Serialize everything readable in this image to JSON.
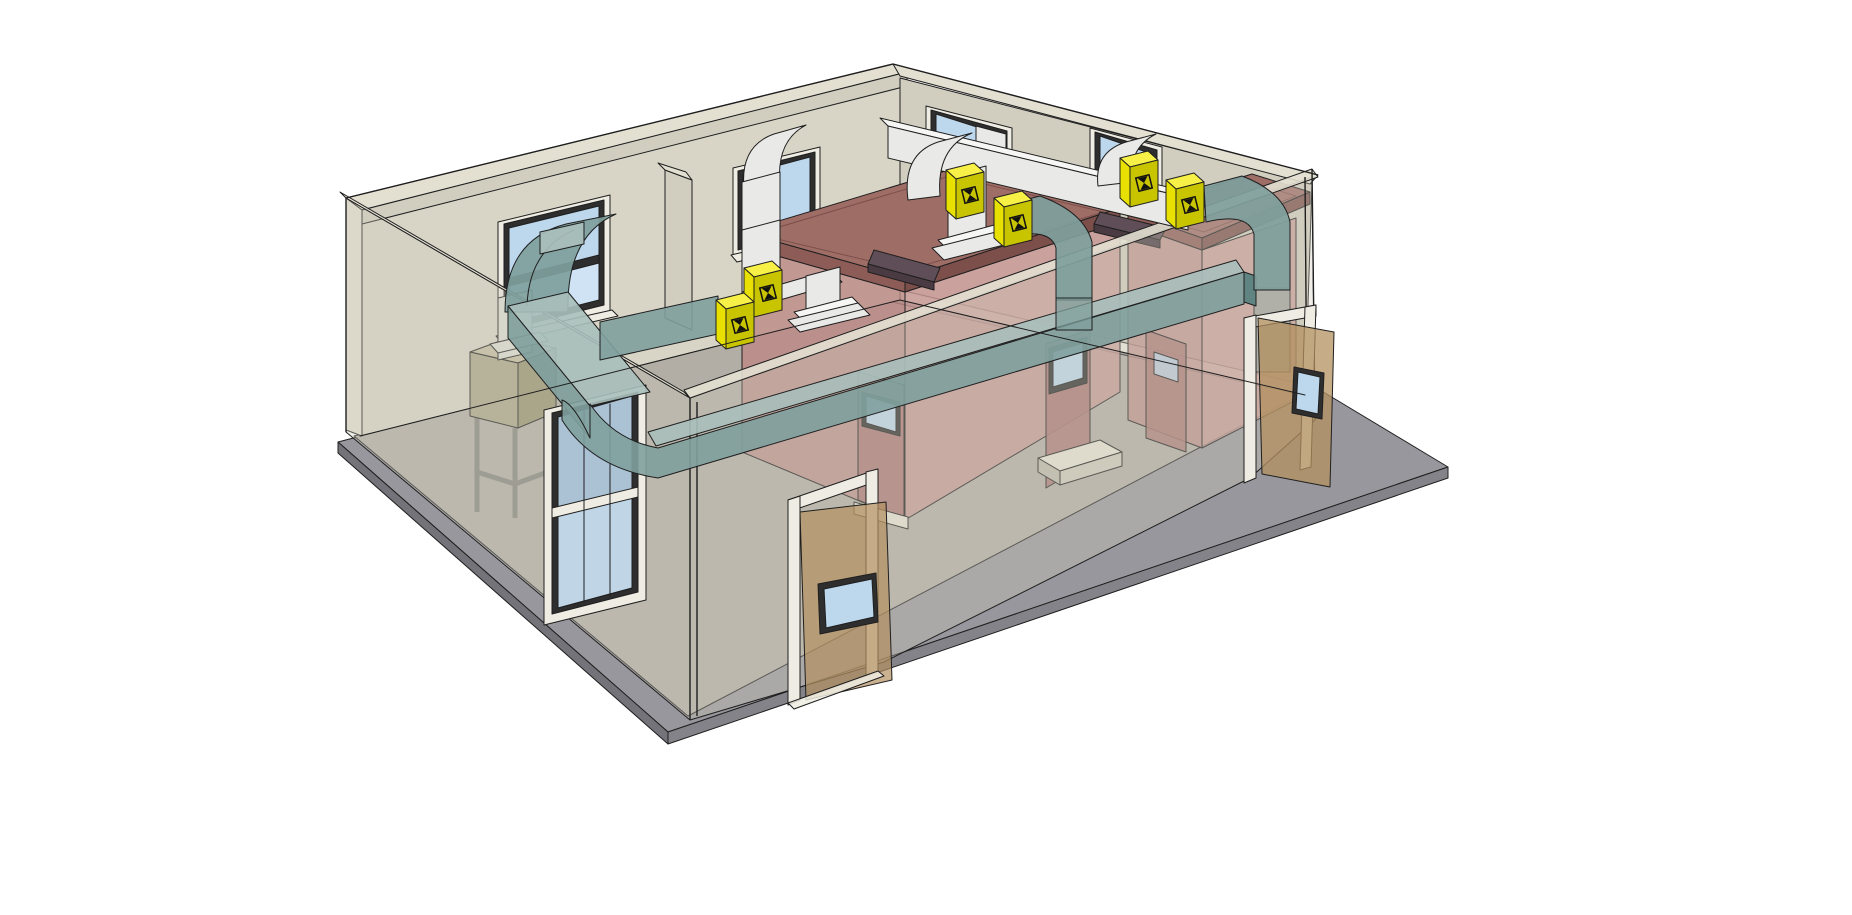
{
  "viewport": {
    "width": 1852,
    "height": 915,
    "background": "#ffffff",
    "description": "3D perspective model of a single-storey plant room: beige walls (front walls translucent), gray concrete slab apron, two red-brown test chambers with maroon roofs and vision-panel doors, white supply ductwork along the rear walls with drops and diffuser bases, teal extract ductwork looping around the room, yellow inline dampers, four rear windows, a glazed partition screen, a filter box on a stand, and two open timber doors"
  },
  "palette": {
    "line": "#1f1f1f",
    "wallA": "#d8d5c7",
    "wallB": "#d1cec0",
    "wallTop": "#e3e0d2",
    "ghost": "#cfccbe",
    "floorIn": "#b2aea5",
    "slab": "#98979d",
    "slabE": "#84838a",
    "slabE2": "#74737a",
    "glass": "#bdd7ec",
    "glass2": "#cfe3f4",
    "frameWhite": "#efede3",
    "frameDark": "#2e2e2e",
    "roof": "#9e6d66",
    "roofE": "#8d5c57",
    "roofE2": "#7d4f4b",
    "redWall": "#bd8a86",
    "redWall2": "#c89794",
    "redDoor": "#a87672",
    "slot": "#5f4e57",
    "slotS": "#4a3b43",
    "ductTop": "#f6f6f4",
    "ductFace": "#e9e9e7",
    "ductSide": "#d8d8d6",
    "teal": "#7fa09d",
    "tealTop": "#a9bfbb",
    "tealDark": "#5f8481",
    "ductLight": "#dcdcd4",
    "damperTop": "#f6f047",
    "damperFace": "#e8e000",
    "damperSide": "#c9c400",
    "glyph": "#111111",
    "doorWood": "#b3905f",
    "stepTop": "#e6e3d5",
    "stepFace": "#cdcabc",
    "stepSide": "#bdbaac",
    "boxTop": "#c2bc9e",
    "boxFace": "#aaa488",
    "boxS": "#97926f",
    "boxSide": "#97926f",
    "stand": "#85857f"
  },
  "scene": {
    "ground": {
      "slab": "concrete apron slab",
      "interior": "interior screed floor"
    },
    "building": {
      "walls": [
        "back-left wall",
        "back-right wall",
        "front-left wall (translucent)",
        "front-right wall (translucent)"
      ],
      "window_count": 4,
      "partition_stub": "interior partition stub wall",
      "glazed_screen": "full-height glazed partition screen"
    },
    "chambers": {
      "count": 2,
      "color": "red-brown",
      "chamber_a": {
        "doors": 2,
        "roof_slot_vents": 1,
        "step_blocks": 2
      },
      "chamber_b": {
        "doors": 1,
        "roof_slot_vents": 1
      }
    },
    "ductwork": {
      "supply": "white rectangular duct run along rear wall with window elbows and two ceiling drops with flared diffuser bases",
      "extract": "teal rectangular duct loop with window elbow, rounded corner bend, two down-drops and end riser",
      "damper_count": 6,
      "damper_color": "yellow",
      "damper_symbol": "black bowtie damper glyph"
    },
    "openings": {
      "open_doors": 2,
      "door_material": "timber with glazed vision panel"
    },
    "equipment": {
      "filter_box": "khaki filter/fan box on steel stand below extract elbow"
    }
  }
}
